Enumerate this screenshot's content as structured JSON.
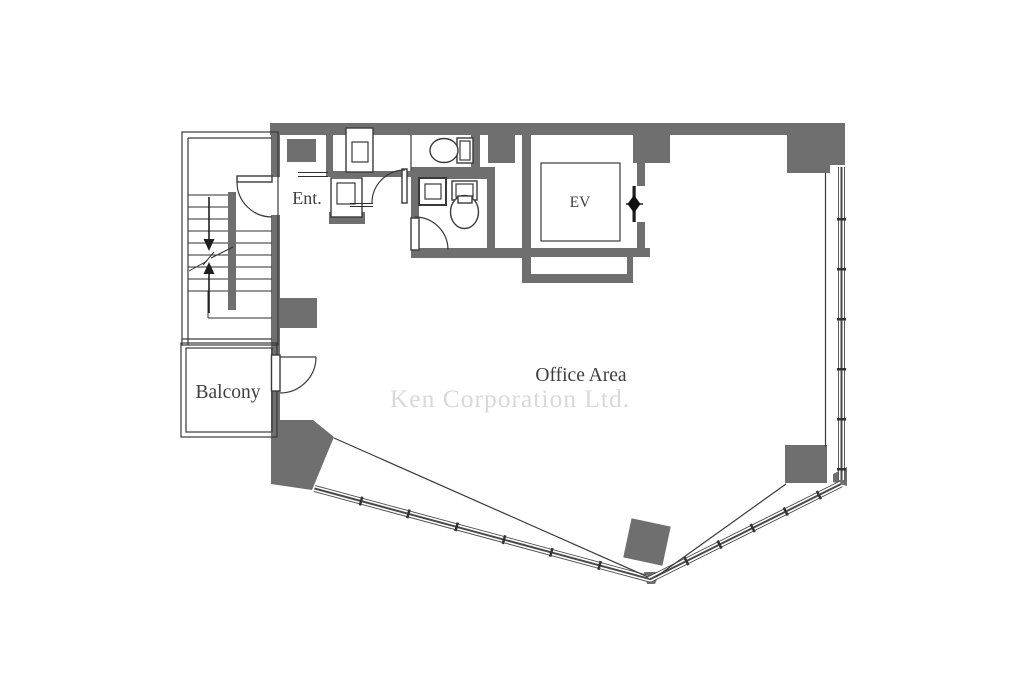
{
  "colors": {
    "background": "#ffffff",
    "wall": "#6f6f6f",
    "line": "#3a3a3a",
    "window": "#4a4a4a",
    "text": "#3f3f3f",
    "watermark": "#d9d9d9"
  },
  "floor_plan": {
    "labels": {
      "entrance": "Ent.",
      "elevator": "EV",
      "balcony": "Balcony",
      "office_area": "Office Area"
    },
    "watermark": "Ken Corporation Ltd."
  }
}
